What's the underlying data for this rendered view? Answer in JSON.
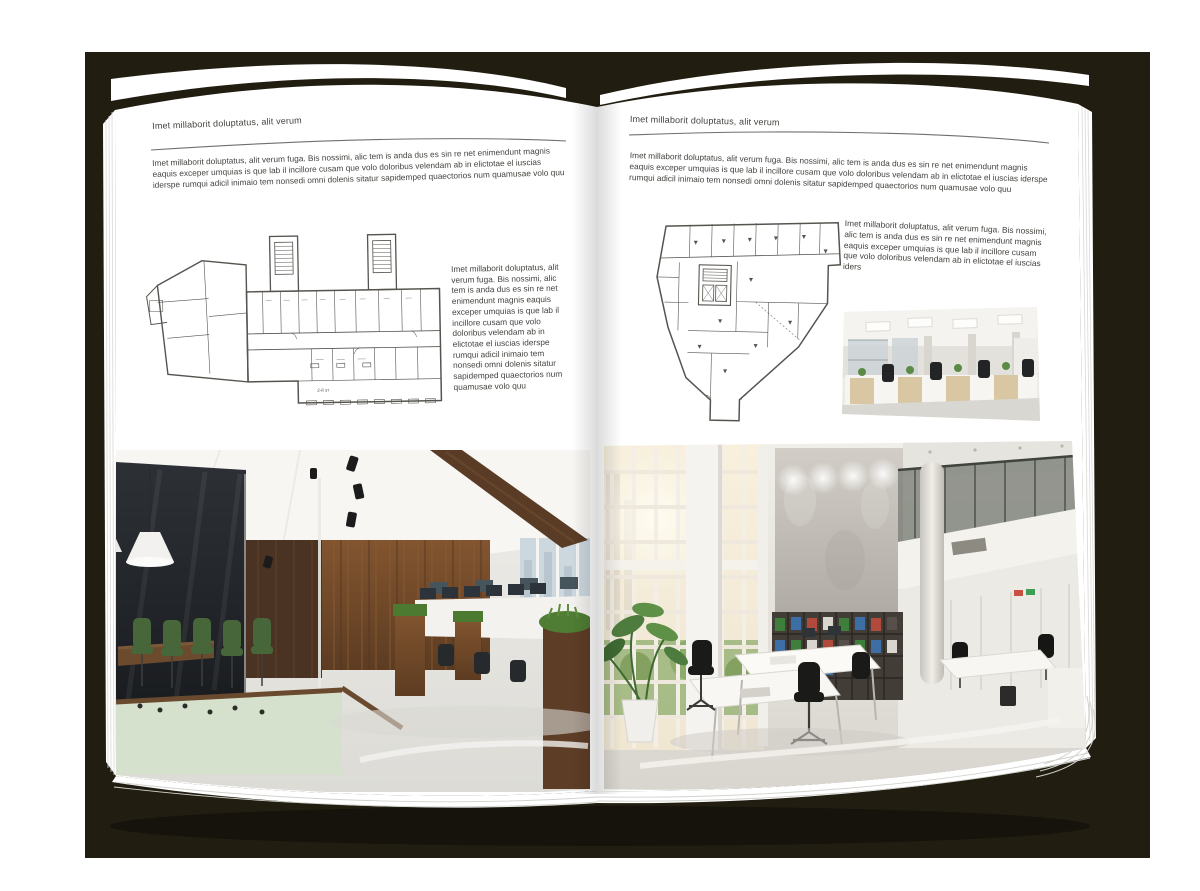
{
  "scene": {
    "description": "Open magazine spread mockup on dark backdrop with floor plans and office interior photos",
    "backdrop_color": "#211e11",
    "paper_color": "#ffffff",
    "text_color": "#44423e"
  },
  "left_page": {
    "header": "Imet millaborit doluptatus, alit verum",
    "intro": "Imet millaborit doluptatus, alit verum fuga. Bis nossimi, alic tem is anda dus es sin re net enimendunt magnis eaquis exceper umquias is que lab il incillore cusam que volo doloribus velendam ab in elictotae el iuscias iderspe rumqui adicil inimaio tem nonsedi omni dolenis sitatur sapidemped quaectorios num quamusae volo quu",
    "floorplan_label": "2-й эт",
    "side_text": "Imet millaborit doluptatus, alit verum fuga. Bis nossimi, alic tem is anda dus es sin re net enimendunt magnis eaquis exceper umquias is que lab il incillore cusam que volo doloribus velendam ab in elictotae el iuscias iderspe rumqui adicil inimaio tem nonsedi omni dolenis sitatur sapidemped quaectorios num quamusae volo quu"
  },
  "right_page": {
    "header": "Imet millaborit doluptatus, alit verum",
    "intro": "Imet millaborit doluptatus, alit verum fuga. Bis nossimi, alic tem is anda dus es sin re net enimendunt magnis eaquis exceper umquias is que lab il incillore cusam que volo doloribus velendam ab in elictotae el iuscias iderspe rumqui adicil inimaio tem nonsedi omni dolenis sitatur sapidemped quaectorios num quamusae volo quu",
    "side_text": "Imet millaborit doluptatus, alit verum fuga. Bis nossimi, alic tem is anda dus es sin re net enimendunt magnis eaquis exceper umquias is que lab il incillore cusam que volo doloribus velendam ab in elictotae el iuscias iders"
  }
}
